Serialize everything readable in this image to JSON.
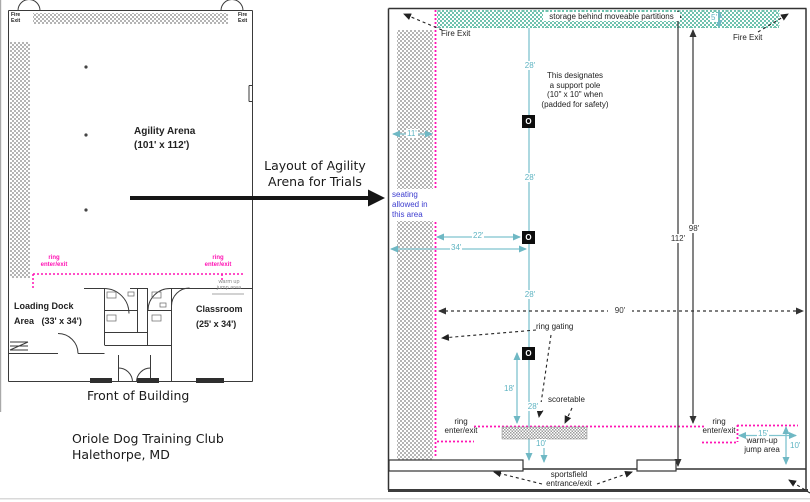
{
  "colors": {
    "magenta": "#ff14b4",
    "teal_dim": "#6fb8c4",
    "storage_teal": "#6fc2ae",
    "seating_blue": "#3c3ccf",
    "hatch_grey": "#b4b4b4",
    "line_dark": "#333333"
  },
  "left_plan": {
    "fire_exit_top_left": [
      "Fire",
      "Exit"
    ],
    "fire_exit_top_right": [
      "Fire",
      "Exit"
    ],
    "arena_title": "Agility Arena",
    "arena_dims": "(101' x 112')",
    "ring_enter_left": [
      "ring",
      "enter/exit"
    ],
    "ring_enter_right": [
      "ring",
      "enter/exit"
    ],
    "warmup_note": [
      "warm up",
      "jump area"
    ],
    "loading_dock": [
      "Loading Dock",
      "Area   (33' x 34')"
    ],
    "classroom": [
      "Classroom",
      "(25' x 34')"
    ],
    "caption": "Front of Building"
  },
  "connector": {
    "label": [
      "Layout of Agility",
      "Arena for Trials"
    ]
  },
  "club": {
    "name": "Oriole Dog Training Club",
    "location": "Halethorpe, MD"
  },
  "right_plan": {
    "storage_label": "storage behind moveable partitions",
    "fire_exit_left": "Fire Exit",
    "fire_exit_right": "Fire Exit",
    "pole_note": [
      "This designates",
      "a support pole",
      "(10\" x 10\" when",
      "(padded for safety)"
    ],
    "seating_note": [
      "seating",
      "allowed in",
      "this area"
    ],
    "pole_glyph": "O",
    "ring_gating_label": "ring gating",
    "scoretable_label": "scoretable",
    "ring_enter_left": [
      "ring",
      "enter/exit"
    ],
    "ring_enter_right": [
      "ring",
      "enter/exit"
    ],
    "warmup_label": [
      "warm-up",
      "jump area"
    ],
    "sportsfield_label": [
      "sportsfield",
      "entrance/exit"
    ],
    "dims": {
      "d5": "5'",
      "d10": "10'",
      "d11": "11'",
      "d15": "15'",
      "d18": "18'",
      "d22": "22'",
      "d28": "28'",
      "d34": "34'",
      "d90": "90'",
      "d98": "98'",
      "d112": "112'"
    }
  }
}
